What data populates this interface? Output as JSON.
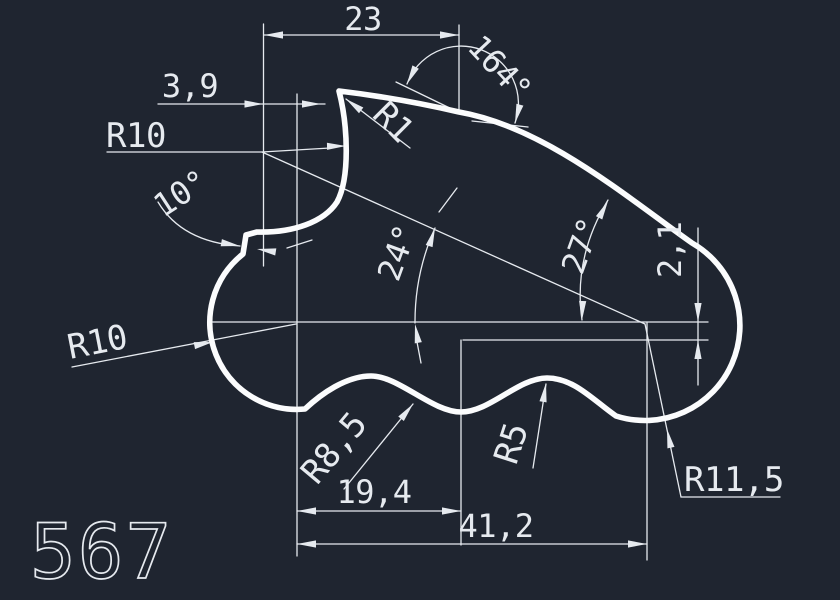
{
  "colors": {
    "background": "#1f2530",
    "outline": "#fbfcfd",
    "dimension": "#e6eaef"
  },
  "part_label": "567",
  "dimensions": {
    "top_width": "23",
    "top_offset": "3,9",
    "tip_angle": "164°",
    "tip_radius": "R1",
    "upper_concave_radius": "R10",
    "notch_angle": "10°",
    "mid_angle": "24°",
    "slope_angle": "27°",
    "right_drop": "2,1",
    "left_lobe_radius": "R10",
    "left_dip_radius": "R8,5",
    "right_dip_radius": "R5",
    "right_lobe_radius": "R11,5",
    "mid_length": "19,4",
    "overall_length": "41,2"
  }
}
